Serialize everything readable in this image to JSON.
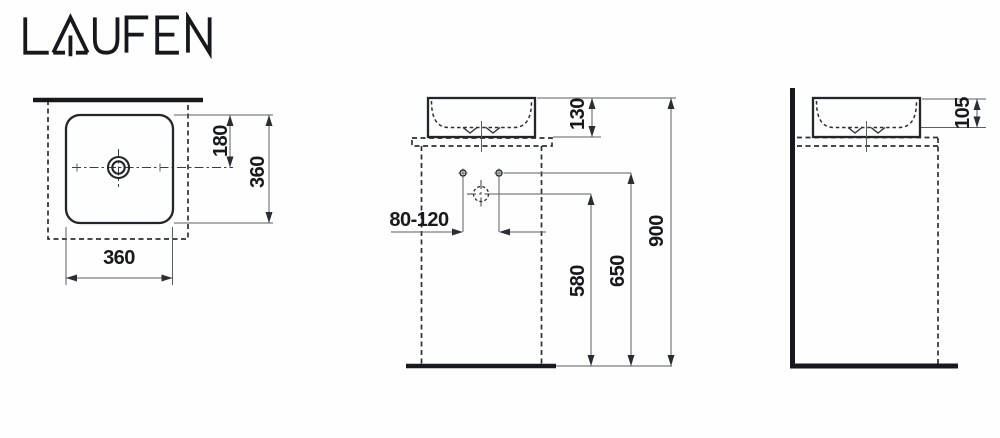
{
  "brand": {
    "name": "LAUFEN"
  },
  "drawing": {
    "title": "Washbasin installation dimension drawing",
    "units": "mm",
    "colors": {
      "line": "#22252a",
      "thick_line": "#17191c",
      "dim_line": "#5a5f66",
      "text": "#17191d",
      "background": "#ffffff"
    },
    "views": {
      "top": {
        "label": "top view",
        "dims": {
          "depth_to_drain": "180",
          "depth": "360",
          "width": "360"
        }
      },
      "front": {
        "label": "front view",
        "dims": {
          "basin_height": "130",
          "tap_distance": "80-120",
          "drain_outlet_height": "580",
          "supply_height": "650",
          "rim_height": "900"
        }
      },
      "side": {
        "label": "side view",
        "dims": {
          "bowl_depth": "105"
        }
      }
    }
  }
}
